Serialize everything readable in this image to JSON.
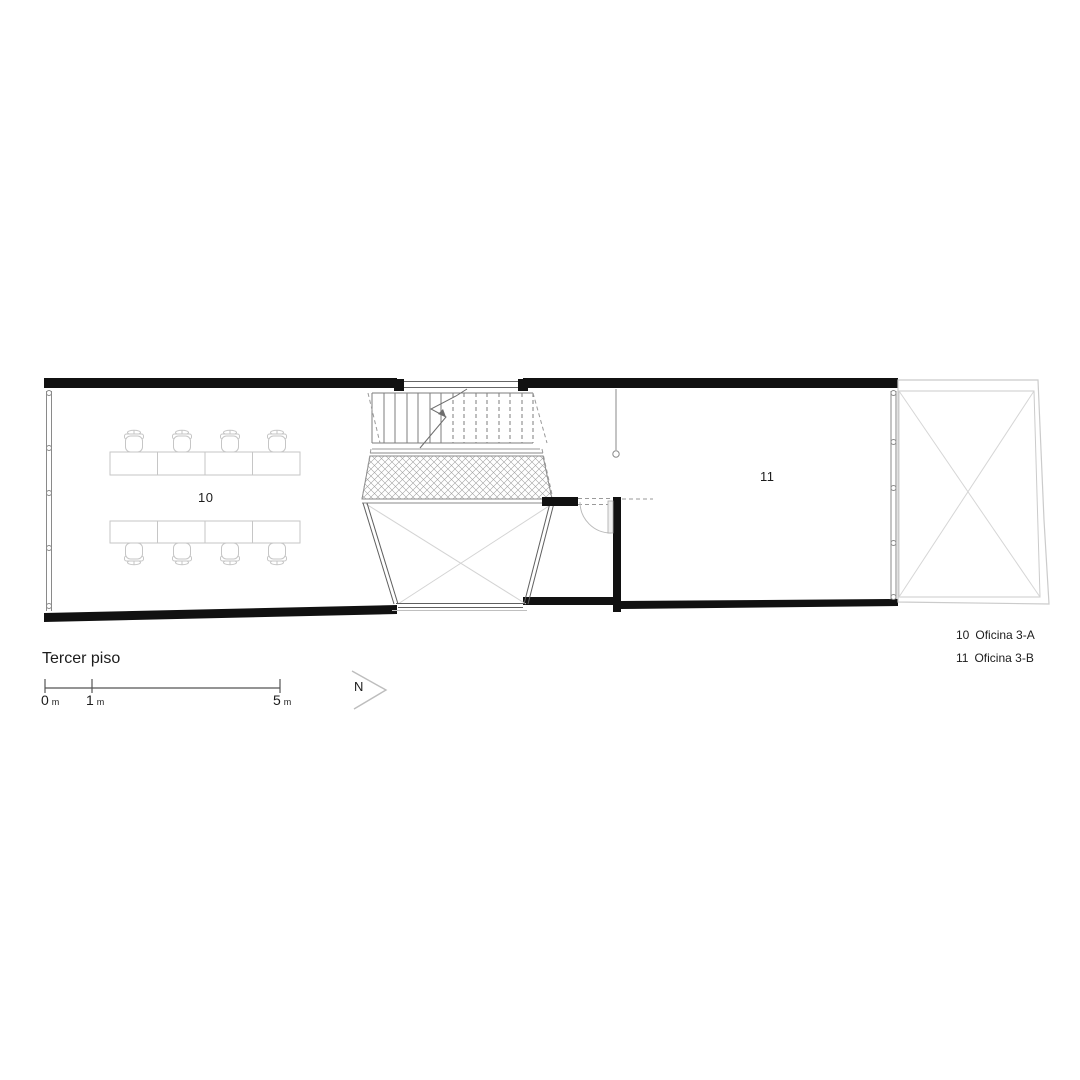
{
  "drawing": {
    "title": "Tercer piso",
    "rooms": [
      {
        "number": "10",
        "name": "Oficina 3-A"
      },
      {
        "number": "11",
        "name": "Oficina 3-B"
      }
    ],
    "legend": [
      {
        "number": "10",
        "name": "Oficina 3-A"
      },
      {
        "number": "11",
        "name": "Oficina 3-B"
      }
    ],
    "scale_bar": {
      "marks": [
        {
          "value": "0",
          "unit": "m"
        },
        {
          "value": "1",
          "unit": "m"
        },
        {
          "value": "5",
          "unit": "m"
        }
      ]
    },
    "north_arrow": {
      "label": "N"
    },
    "colors": {
      "wall": "#111111",
      "thin_line": "#555555",
      "light_line": "#c4c4c4",
      "background": "#ffffff"
    }
  }
}
